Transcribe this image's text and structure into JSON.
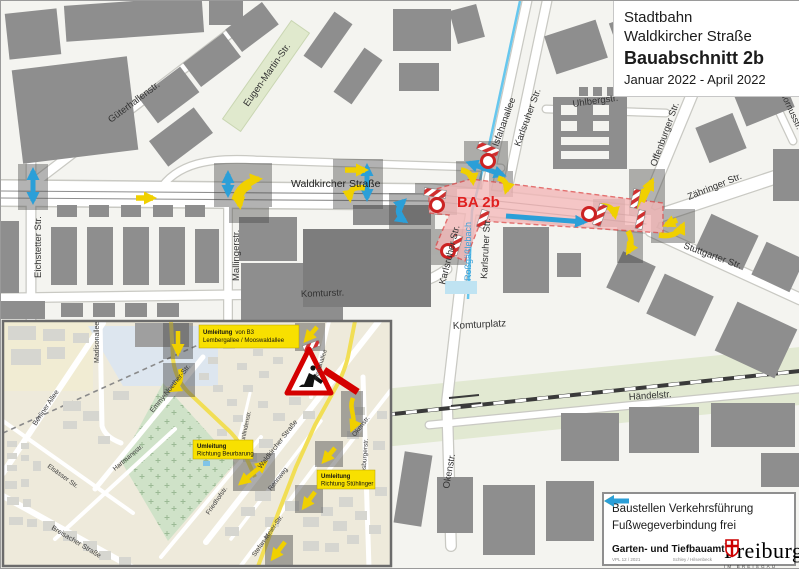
{
  "colors": {
    "detour_yellow": "#f0d000",
    "footpath_blue": "#2b9fd8",
    "zone_fill": "#f3b8b8",
    "zone_red": "#e02020",
    "building_grey": "#8e8e8e"
  },
  "title": {
    "line1": "Stadtbahn",
    "line2": "Waldkircher Straße",
    "line3": "Bauabschnitt 2b",
    "line4": "Januar 2022 - April 2022"
  },
  "legend": {
    "detour": "Baustellen Verkehrsführung",
    "footpath": "Fußwegeverbindung frei"
  },
  "footer": {
    "department": "Garten- und Tiefbauamt",
    "ref": "VPL 12 / 2021",
    "authors": "Schley / Hilsenbeck",
    "city": "Freiburg",
    "city_sub": "IM BREISGAU"
  },
  "main_map": {
    "zone_label": "BA 2b",
    "streets": {
      "gueterhallenstr": "Güterhallenstr.",
      "eugen_martin": "Eugen-Martin-Str.",
      "eichstetter": "Eichstetter Str.",
      "mallingerstr": "Mallingerstr.",
      "waldkircher": "Waldkircher Straße",
      "komturstr": "Komturstr.",
      "komturplatz": "Komturplatz",
      "isfahanallee": "Isfahanallee",
      "karlsruher": "Karlsruher Str.",
      "rossgaesslebach": "Roßgäßlebach",
      "uhlbergstr": "Uhlbergstr.",
      "hornusstr": "Hornusstr.",
      "offenburger": "Offenburger Str.",
      "zaehringer": "Zähringer Str.",
      "stuttgarter": "Stuttgarter Str.",
      "haendelstr": "Händelstr.",
      "okenstr": "Okenstr."
    }
  },
  "inset": {
    "streets": {
      "madisonallee": "Madisonallee",
      "berliner_allee": "Berliner Allee",
      "emmy_noether": "Emmy-Noether-Str.",
      "elsaesser": "Elsässer Str.",
      "breisacher": "Breisacher Straße",
      "hartmannstr": "Hartmannstr.",
      "friedhofstr": "Friedhofstr.",
      "waldkircher": "Waldkircher Straße",
      "rennweg": "Rennweg",
      "neunlindenstr": "Neunlindenstr.",
      "isfahanallee": "Isfahanallee",
      "okenstr": "Okenstr.",
      "habsburgerstr": "Habsburgerstr.",
      "stefan_meier": "Stefan-Meier-Str."
    },
    "detours": {
      "b3": {
        "bold": "Umleitung",
        "rest": "von B3",
        "line2": "Lembergallee / Mooswaldallee"
      },
      "beurbarung": {
        "bold": "Umleitung",
        "line2": "Richtung Beurbarung"
      },
      "stuehlinger": {
        "bold": "Umleitung",
        "line2": "Richtung Stühlinger"
      }
    }
  }
}
